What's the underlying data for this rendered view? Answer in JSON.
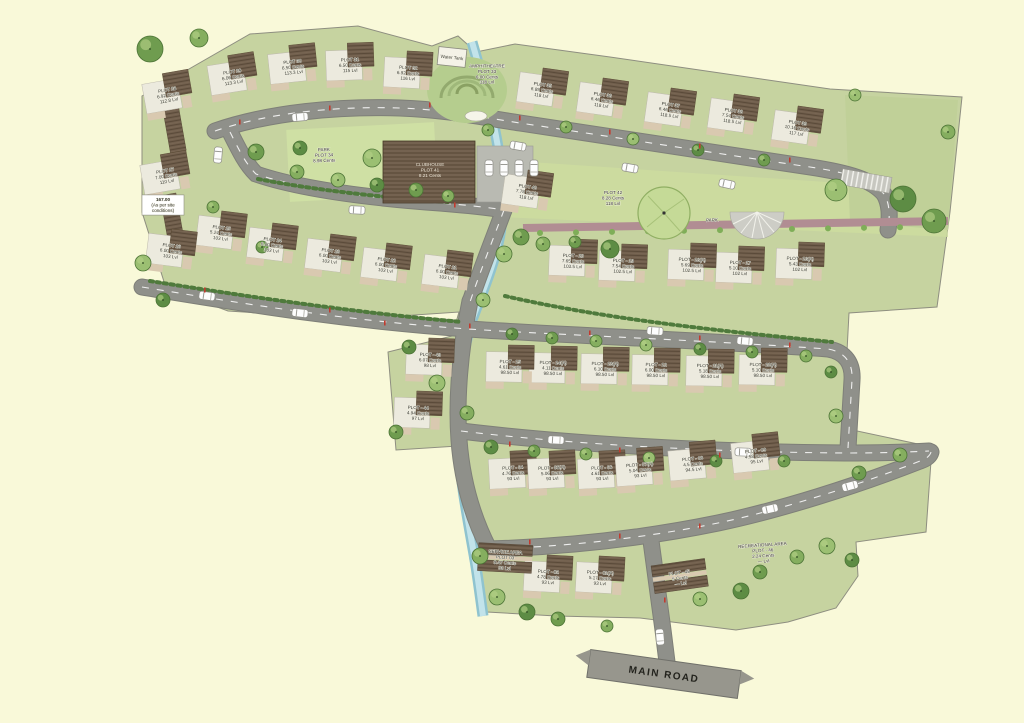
{
  "map": {
    "main_road_label": "MAIN ROAD",
    "water_tank_label": "Water Tank",
    "colors": {
      "background": "#F9F9D9",
      "site_green": "#C6D3A0",
      "road_gray": "#8F908A",
      "water_blue": "#AED6DE",
      "park_strip": "#B18D93",
      "roof_brown": "#6F5E4B"
    },
    "plots": [
      {
        "lines": [
          "PLOT - 01(A)",
          "5.17 Cents",
          "93 Lvl"
        ],
        "x": 600,
        "y": 578,
        "angle": 3,
        "type": "house"
      },
      {
        "lines": [
          "PLOT - 02",
          "4.78 Cents",
          "93 Lvl"
        ],
        "x": 548,
        "y": 577,
        "angle": 3,
        "type": "house"
      },
      {
        "lines": [
          "SERVICE AREA",
          "PLOT 03",
          "9.47 Cents",
          "93 Lvl"
        ],
        "x": 505,
        "y": 560,
        "angle": 3,
        "type": "shed"
      },
      {
        "lines": [
          "PLOT - 04",
          "4.76 Cents",
          "93 Lvl"
        ],
        "x": 513,
        "y": 473,
        "angle": -3,
        "type": "house"
      },
      {
        "lines": [
          "PLOT - 05(A)",
          "5.06 Cents",
          "93 Lvl"
        ],
        "x": 552,
        "y": 473,
        "angle": -3,
        "type": "house"
      },
      {
        "lines": [
          "PLOT - 06",
          "4.61 Cents",
          "93 Lvl"
        ],
        "x": 602,
        "y": 473,
        "angle": -3,
        "type": "house"
      },
      {
        "lines": [
          "PLOT - 07(A)",
          "5.04 Cents",
          "93 Lvl"
        ],
        "x": 640,
        "y": 470,
        "angle": -4,
        "type": "house"
      },
      {
        "lines": [
          "PLOT - 08",
          "4.5 Cents",
          "94.5 Lvl"
        ],
        "x": 693,
        "y": 464,
        "angle": -5,
        "type": "house"
      },
      {
        "lines": [
          "PLOT - 09",
          "4.58 Cents",
          "95 Lvl"
        ],
        "x": 756,
        "y": 456,
        "angle": -6,
        "type": "house"
      },
      {
        "lines": [
          "PLOT - 10(A)",
          "5.10 Cents",
          "98.50 Lvl"
        ],
        "x": 763,
        "y": 370,
        "angle": 1,
        "type": "house"
      },
      {
        "lines": [
          "PLOT - 11(A)",
          "5.18 Cents",
          "98.50 Lvl"
        ],
        "x": 710,
        "y": 371,
        "angle": 1,
        "type": "house"
      },
      {
        "lines": [
          "PLOT - 12",
          "6.00 Cents",
          "98.50 Lvl"
        ],
        "x": 656,
        "y": 370,
        "angle": 1,
        "type": "house"
      },
      {
        "lines": [
          "PLOT - 13(A)",
          "6.10 Cents",
          "98.50 Lvl"
        ],
        "x": 605,
        "y": 369,
        "angle": 1,
        "type": "house"
      },
      {
        "lines": [
          "PLOT - 14(A)",
          "4.11 Cents",
          "98.50 Lvl"
        ],
        "x": 553,
        "y": 368,
        "angle": 1,
        "type": "house"
      },
      {
        "lines": [
          "PLOT - 15",
          "4.61 Cents",
          "98.50 Lvl"
        ],
        "x": 510,
        "y": 367,
        "angle": 1,
        "type": "house"
      },
      {
        "lines": [
          "PLOT - 16(A)",
          "5.43 Cents",
          "102 Lvl"
        ],
        "x": 800,
        "y": 264,
        "angle": 2,
        "type": "house"
      },
      {
        "lines": [
          "PLOT - 17",
          "5.10 Cents",
          "102 Lvl"
        ],
        "x": 740,
        "y": 268,
        "angle": 2,
        "type": "house"
      },
      {
        "lines": [
          "PLOT - 18(A)",
          "5.69 Cents",
          "102.5 Lvl"
        ],
        "x": 692,
        "y": 265,
        "angle": 2,
        "type": "house"
      },
      {
        "lines": [
          "PLOT - 19",
          "7.54 Cents",
          "102.5 Lvl"
        ],
        "x": 623,
        "y": 266,
        "angle": 2,
        "type": "house"
      },
      {
        "lines": [
          "PLOT - 20",
          "7.65 Cents",
          "103.5 Lvl"
        ],
        "x": 573,
        "y": 261,
        "angle": 2,
        "type": "house"
      },
      {
        "lines": [
          "PLOT 21",
          "6.00 Cents",
          "103 Lvl"
        ],
        "x": 447,
        "y": 272,
        "angle": 7,
        "type": "house"
      },
      {
        "lines": [
          "PLOT 22",
          "6.00 Cents",
          "103 Lvl"
        ],
        "x": 386,
        "y": 265,
        "angle": 7,
        "type": "house"
      },
      {
        "lines": [
          "PLOT 23",
          "6.00 Cents",
          "103 Lvl"
        ],
        "x": 330,
        "y": 256,
        "angle": 7,
        "type": "house"
      },
      {
        "lines": [
          "PLOT 24",
          "6.00 Cents",
          "103 Lvl"
        ],
        "x": 272,
        "y": 245,
        "angle": 7,
        "type": "house"
      },
      {
        "lines": [
          "PLOT 25",
          "5.24 Cents",
          "103 Lvl"
        ],
        "x": 221,
        "y": 233,
        "angle": 7,
        "type": "house"
      },
      {
        "lines": [
          "PLOT 26",
          "6.00 Cents",
          "103 Lvl"
        ],
        "x": 171,
        "y": 251,
        "angle": 7,
        "type": "house"
      },
      {
        "lines": [
          "PLOT 27",
          "7.00 Cents",
          "110 Lvl"
        ],
        "x": 166,
        "y": 176,
        "angle": -10,
        "type": "house"
      },
      {
        "lines": [
          "PLOT 28",
          "6.92 Cents",
          "112.8 Lvl"
        ],
        "x": 168,
        "y": 95,
        "angle": -10,
        "type": "house"
      },
      {
        "lines": [
          "PLOT 29",
          "6.06 Cents",
          "113.3 Lvl"
        ],
        "x": 233,
        "y": 77,
        "angle": -9,
        "type": "house"
      },
      {
        "lines": [
          "PLOT 30",
          "6.50 Cents",
          "113.3 Lvl"
        ],
        "x": 293,
        "y": 67,
        "angle": -6,
        "type": "house"
      },
      {
        "lines": [
          "PLOT 31",
          "6.50 Cents",
          "115 Lvl"
        ],
        "x": 350,
        "y": 65,
        "angle": -2,
        "type": "house"
      },
      {
        "lines": [
          "PLOT 32",
          "6.92 Cents",
          "116 Lvl"
        ],
        "x": 408,
        "y": 73,
        "angle": 3,
        "type": "house"
      },
      {
        "lines": [
          "AMPHITHEATRE",
          "PLOT 33",
          "6.00 Cents",
          "118 Lvl"
        ],
        "x": 487,
        "y": 74,
        "angle": 0,
        "type": "label"
      },
      {
        "lines": [
          "PARK",
          "PLOT 34",
          "8.98 Cents"
        ],
        "x": 324,
        "y": 155,
        "angle": -2,
        "type": "label"
      },
      {
        "lines": [
          "PLOT 35",
          "6.89 Cents",
          "118 Lvl"
        ],
        "x": 542,
        "y": 90,
        "angle": 8,
        "type": "house"
      },
      {
        "lines": [
          "PLOT 36",
          "6.46 Cents",
          "118 Lvl"
        ],
        "x": 602,
        "y": 100,
        "angle": 8,
        "type": "house"
      },
      {
        "lines": [
          "PLOT 37",
          "6.46 Cents",
          "118.5 Lvl"
        ],
        "x": 670,
        "y": 110,
        "angle": 8,
        "type": "house"
      },
      {
        "lines": [
          "PLOT 38",
          "7.54 Cents",
          "118.5 Lvl"
        ],
        "x": 733,
        "y": 116,
        "angle": 8,
        "type": "house"
      },
      {
        "lines": [
          "PLOT 39",
          "10.16 Cents",
          "117 Lvl"
        ],
        "x": 797,
        "y": 128,
        "angle": 8,
        "type": "house"
      },
      {
        "lines": [
          "PLOT 40",
          "7.78 Cents",
          "118 Lvl"
        ],
        "x": 527,
        "y": 192,
        "angle": 8,
        "type": "house"
      },
      {
        "lines": [
          "CLUBHOUSE",
          "PLOT 41",
          "8.21 Cents"
        ],
        "x": 430,
        "y": 170,
        "angle": 0,
        "type": "label",
        "light": true
      },
      {
        "lines": [
          "PLOT 42",
          "8.28 Cents",
          "118 Lvl"
        ],
        "x": 613,
        "y": 198,
        "angle": 0,
        "type": "label"
      },
      {
        "lines": [
          "PLOT - 43",
          "6.07 Cents",
          "98 Lvl"
        ],
        "x": 430,
        "y": 360,
        "angle": 2,
        "type": "house"
      },
      {
        "lines": [
          "PLOT - 44",
          "4.94 Cents",
          "97 Lvl"
        ],
        "x": 418,
        "y": 413,
        "angle": 2,
        "type": "house"
      },
      {
        "lines": [
          "PLOT - 45",
          "5 Cents",
          "— Lvl"
        ],
        "x": 680,
        "y": 578,
        "angle": -8,
        "type": "shed"
      },
      {
        "lines": [
          "RECREATIONAL AREA",
          "PLOT - 46",
          "2.24 Cents",
          "— Lvl"
        ],
        "x": 763,
        "y": 553,
        "angle": -4,
        "type": "label"
      },
      {
        "lines": [
          "PARK"
        ],
        "x": 712,
        "y": 220,
        "angle": -1,
        "type": "label"
      },
      {
        "lines": [
          "167.00",
          "(As per site",
          "conditions)"
        ],
        "x": 163,
        "y": 205,
        "angle": 0,
        "type": "note"
      }
    ]
  }
}
